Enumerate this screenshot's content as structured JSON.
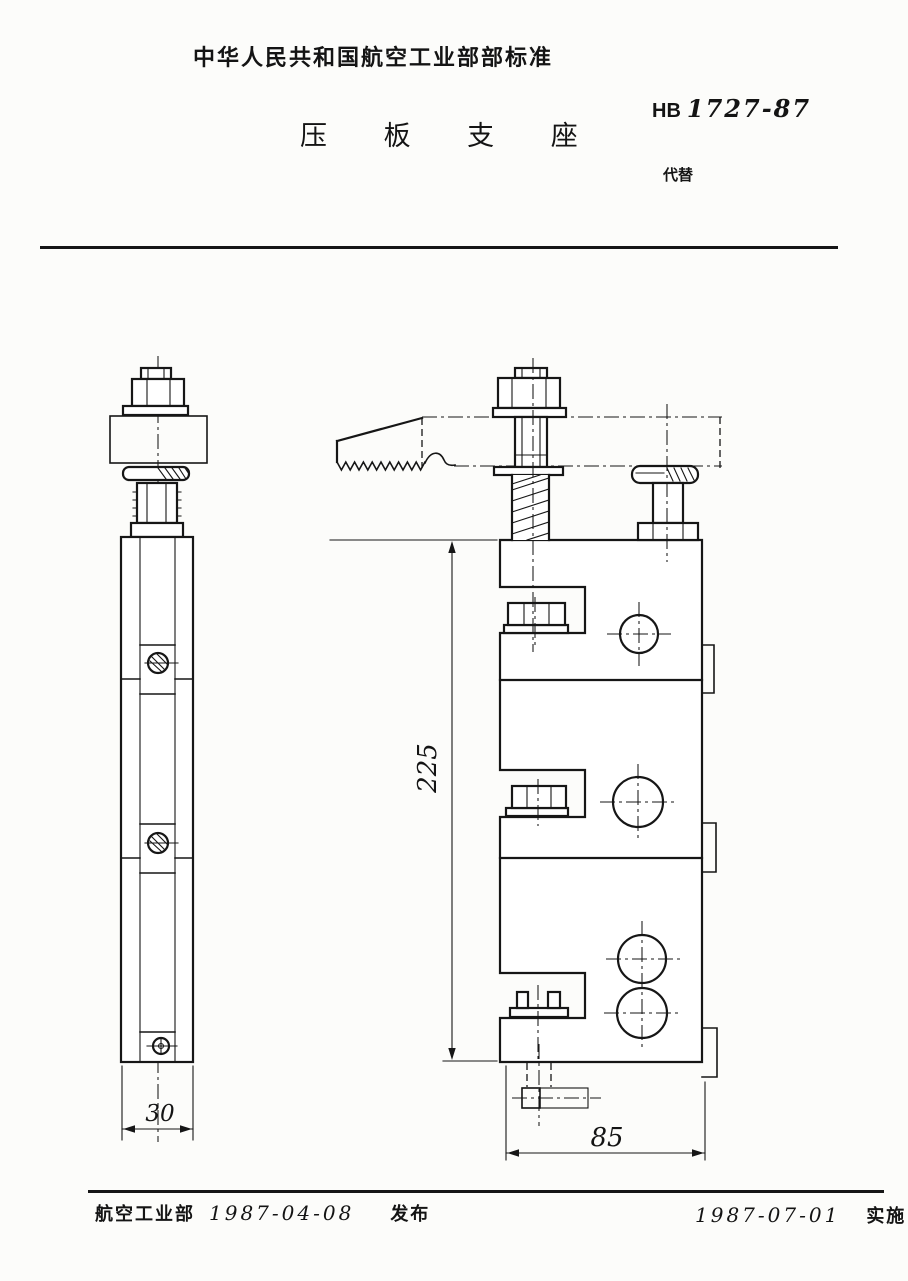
{
  "document": {
    "header_title": "中华人民共和国航空工业部部标准",
    "standard_code_prefix": "HB",
    "standard_code_number": "1727-87",
    "replaces_label": "代替",
    "drawing_title": "压 板 支 座"
  },
  "drawing": {
    "dimensions": {
      "overall_height": "225",
      "side_width": "30",
      "front_width": "85"
    }
  },
  "footer": {
    "issuing_body": "航空工业部",
    "issue_date": "1987-04-08",
    "issue_action_label": "发布",
    "implementation_date": "1987-07-01",
    "implementation_action_label": "实施"
  }
}
